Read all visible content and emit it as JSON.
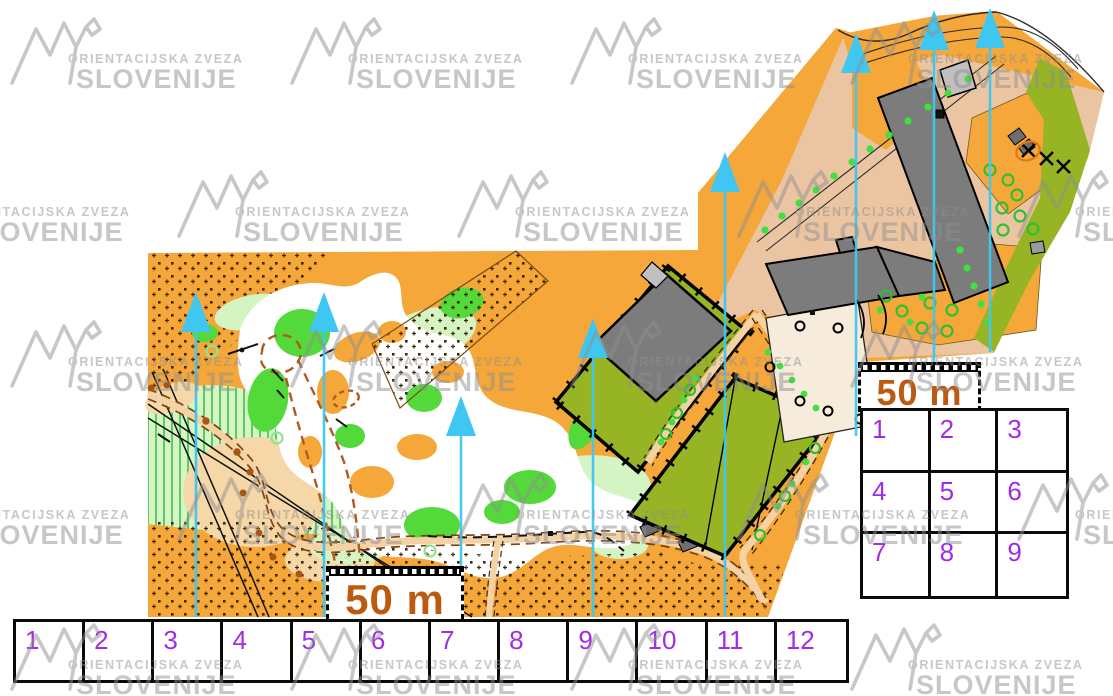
{
  "watermark": {
    "line1": "ORIENTACIJSKA ZVEZA",
    "line2": "SLOVENIJE"
  },
  "scale_bar": {
    "label": "50 m",
    "count": 2
  },
  "grids": {
    "bottom": {
      "cells": [
        "1",
        "2",
        "3",
        "4",
        "5",
        "6",
        "7",
        "8",
        "9",
        "10",
        "11",
        "12"
      ]
    },
    "right": {
      "cells": [
        "1",
        "2",
        "3",
        "4",
        "5",
        "6",
        "7",
        "8",
        "9"
      ]
    }
  },
  "north_arrows": {
    "count": 8
  },
  "colors": {
    "open_orange": "#F5A73A",
    "pavement_peach": "#EBC5A2",
    "olive_green": "#96B424",
    "forest_white": "#FFFFFF",
    "bright_green": "#53D93A",
    "pale_green": "#D5F4C4",
    "building_gray": "#7C7C7C",
    "north_arrow_cyan": "#3FC7F2",
    "grid_number_purple": "#A22BE6",
    "scale_text_brown": "#BD5A0F",
    "watermark_gray": "#C4C4C4"
  }
}
